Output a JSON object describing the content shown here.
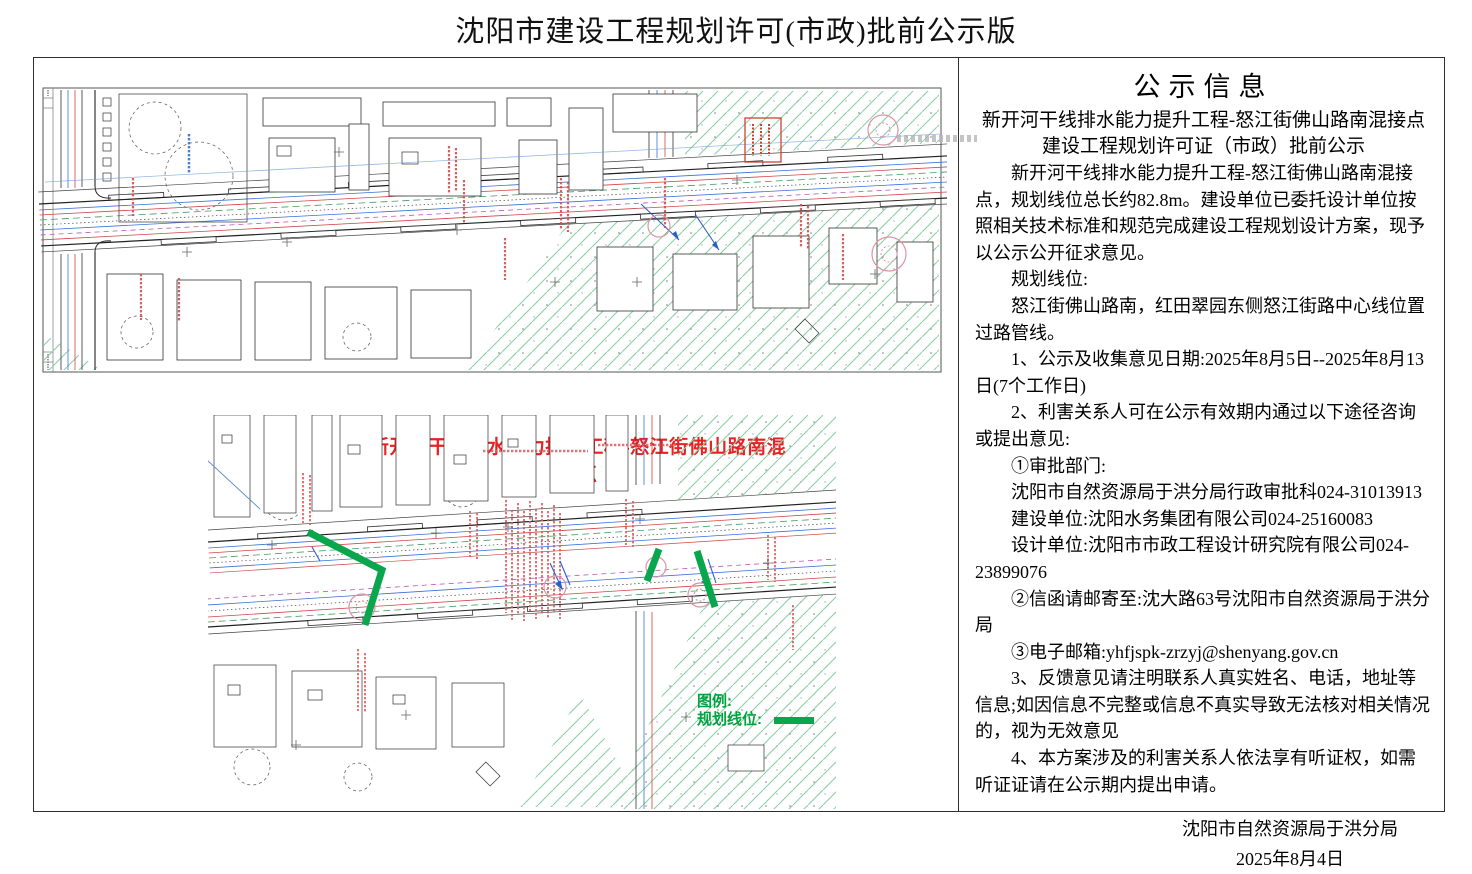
{
  "page": {
    "title": "沈阳市建设工程规划许可(市政)批前公示版"
  },
  "maps": {
    "caption": "新开河干线排水能力提升工程-怒江街佛山路南混接点",
    "legend": {
      "title": "图例:",
      "item_label": "规划线位:"
    }
  },
  "notice": {
    "title": "公示信息",
    "subtitle_lines": [
      "新开河干线排水能力提升工程-怒江街佛山路南混接点",
      "建设工程规划许可证（市政）批前公示"
    ],
    "paragraphs": [
      "新开河干线排水能力提升工程-怒江街佛山路南混接点，规划线位总长约82.8m。建设单位已委托设计单位按照相关技术标准和规范完成建设工程规划设计方案，现予以公示公开征求意见。",
      "规划线位:",
      "怒江街佛山路南，红田翠园东侧怒江街路中心线位置过路管线。",
      "1、公示及收集意见日期:2025年8月5日--2025年8月13日(7个工作日)",
      "2、利害关系人可在公示有效期内通过以下途径咨询或提出意见:",
      "①审批部门:",
      "沈阳市自然资源局于洪分局行政审批科024-31013913",
      "建设单位:沈阳水务集团有限公司024-25160083",
      "设计单位:沈阳市市政工程设计研究院有限公司024-23899076",
      "②信函请邮寄至:沈大路63号沈阳市自然资源局于洪分局",
      "③电子邮箱:yhfjspk-zrzyj@shenyang.gov.cn",
      "3、反馈意见请注明联系人真实姓名、电话，地址等信息;如因信息不完整或信息不真实导致无法核对相关情况的，视为无效意见",
      "4、本方案涉及的利害关系人依法享有听证权，如需听证证请在公示期内提出申请。"
    ],
    "signature": {
      "org": "沈阳市自然资源局于洪分局",
      "date": "2025年8月4日"
    }
  },
  "colors": {
    "planning_line_green": "#0aa64e",
    "legend_text_green": "#00a33f",
    "caption_red": "#e62222",
    "hatch_green": "#8ccfa6",
    "utility_blue": "#3a6fd8",
    "parcel_red": "#d04545",
    "stamp_pink": "#df93a8"
  }
}
